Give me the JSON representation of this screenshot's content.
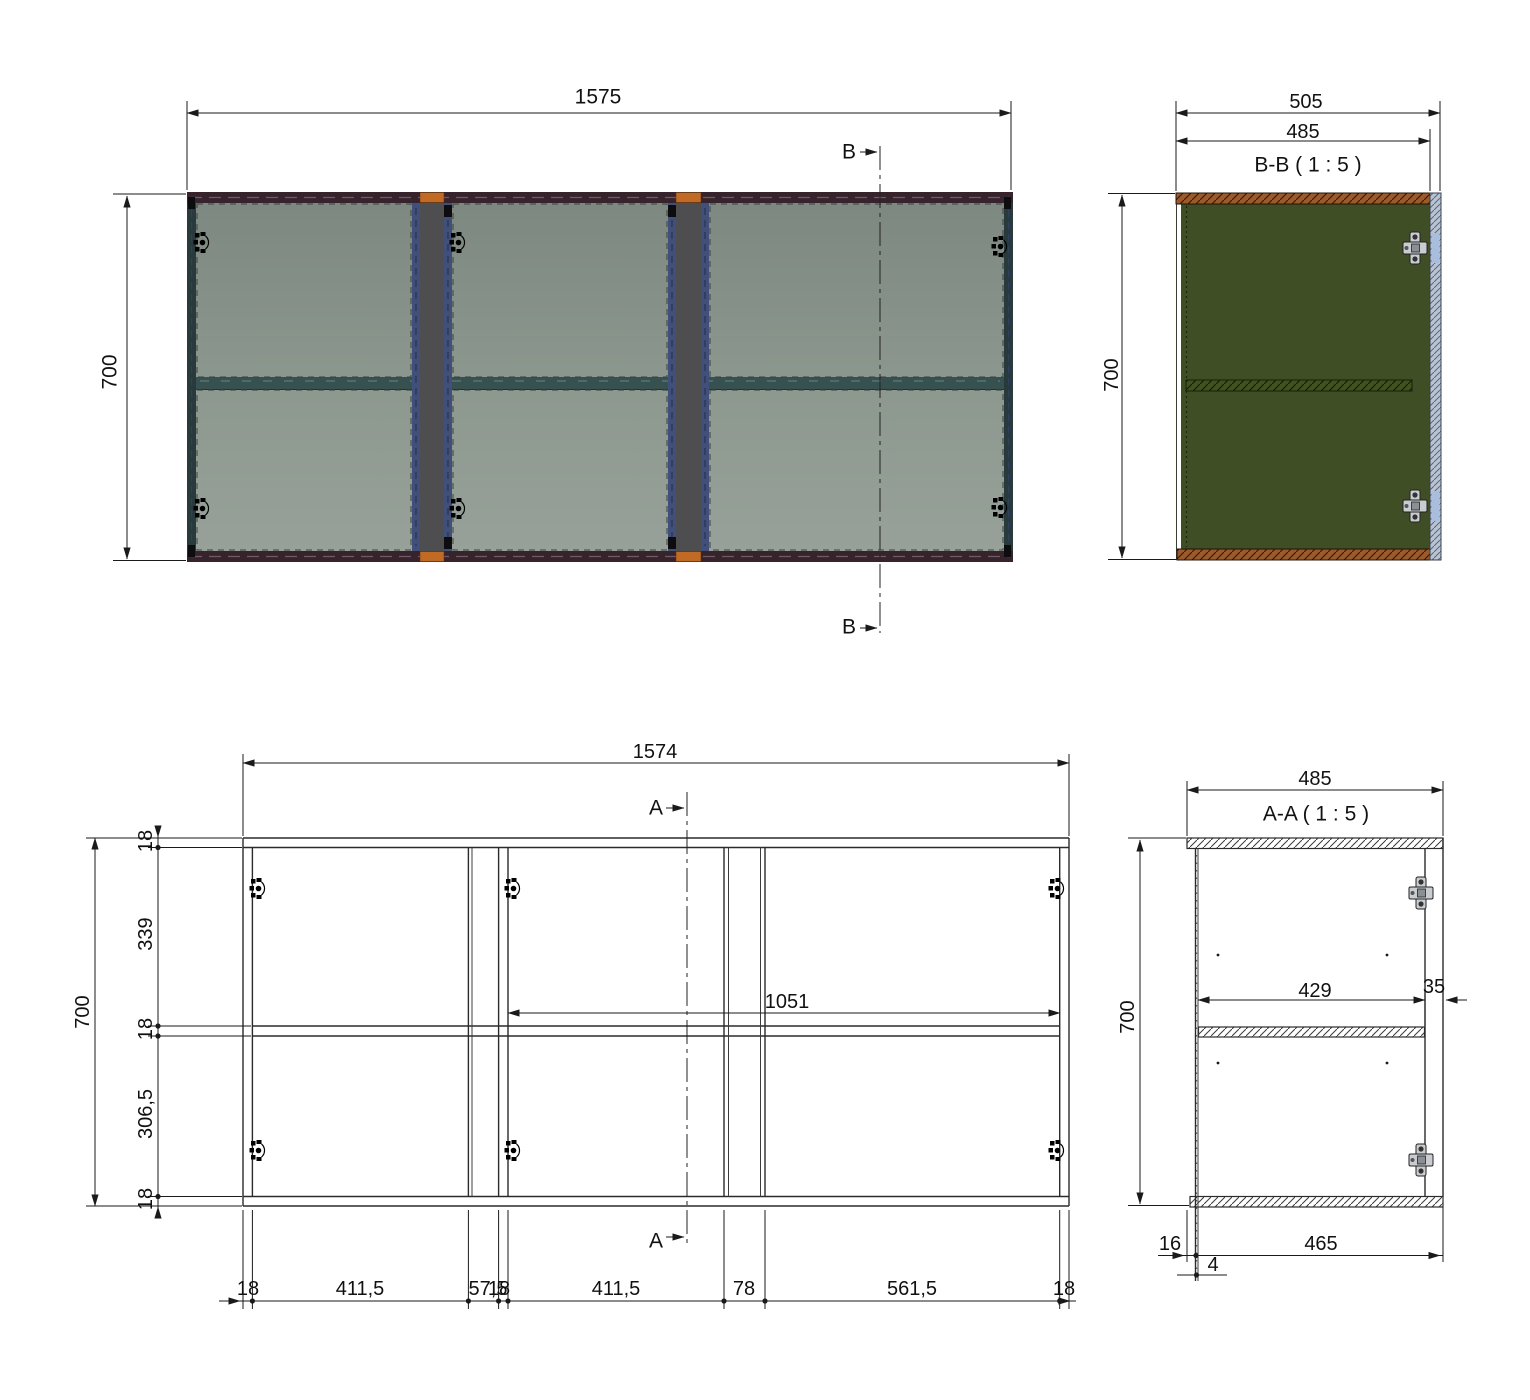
{
  "colors": {
    "line": "#2b2b2b",
    "panel_dark": "#78837c",
    "panel_light": "#98a29a",
    "frame_dark": "#37232c",
    "edge_teal": "#283a3c",
    "divider_gray": "#4e4e50",
    "divider_blue": "#41507b",
    "accent_orange": "#c06a25",
    "shelf_teal": "#375150",
    "section_green": "#3f4e24",
    "section_brown": "#9c5a2a",
    "door_bluegray": "#b9c3d2"
  },
  "front_view": {
    "width_dim": "1575",
    "height_dim": "700",
    "section_letter_top": "B",
    "section_letter_bottom": "B"
  },
  "section_bb": {
    "title": "B-B ( 1 : 5 )",
    "overall_depth_dim": "505",
    "inner_depth_dim": "485",
    "height_dim": "700"
  },
  "front_drawing": {
    "width_dim": "1574",
    "height_dim": "700",
    "section_letter_top": "A",
    "section_letter_bottom": "A",
    "shelf_span_dim": "1051",
    "left_chain": [
      "18",
      "339",
      "18",
      "306,5",
      "18"
    ],
    "bottom_chain": [
      "18",
      "411,5",
      "57,5",
      "18",
      "411,5",
      "78",
      "561,5",
      "18"
    ]
  },
  "section_aa": {
    "title": "A-A ( 1 : 5 )",
    "width_dim": "485",
    "height_dim": "700",
    "interior_depth_dim": "429",
    "front_panel_dim": "35",
    "back_offset_dim": "16",
    "back_panel_dim": "4",
    "bottom_span_dim": "465"
  }
}
